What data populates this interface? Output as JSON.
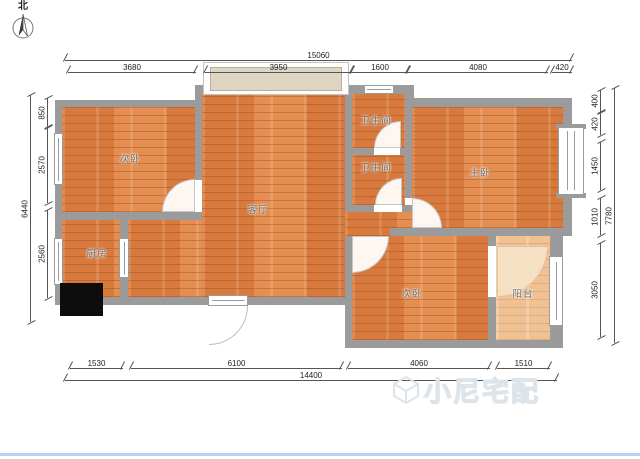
{
  "compass": {
    "label": "北"
  },
  "rooms": {
    "bedroom_top_left": "次卧",
    "living_room": "客厅",
    "bathroom_top": "卫生间",
    "bathroom_mid": "卫生间",
    "master_bedroom": "主卧",
    "kitchen": "厨房",
    "bedroom_bottom": "次卧",
    "balcony": "阳台"
  },
  "dims": {
    "top": {
      "total": "15060",
      "segs": [
        "3680",
        "3950",
        "1600",
        "4080",
        "420"
      ]
    },
    "bottom": {
      "total": "14400",
      "segs": [
        "1530",
        "6100",
        "4060",
        "1510"
      ]
    },
    "left": {
      "total": "6440",
      "segs": [
        "850",
        "2570",
        "2560"
      ]
    },
    "right": {
      "total": "7780",
      "segs": [
        "400",
        "420",
        "1450",
        "1010",
        "3050"
      ]
    }
  },
  "watermark": {
    "text": "小尼宅配"
  },
  "colors": {
    "wall": "#9b9b9b",
    "floor": "#de8144",
    "floor_light": "#f0c193",
    "dim_line": "#555555",
    "bottom_bar": "#b5d6ec"
  }
}
